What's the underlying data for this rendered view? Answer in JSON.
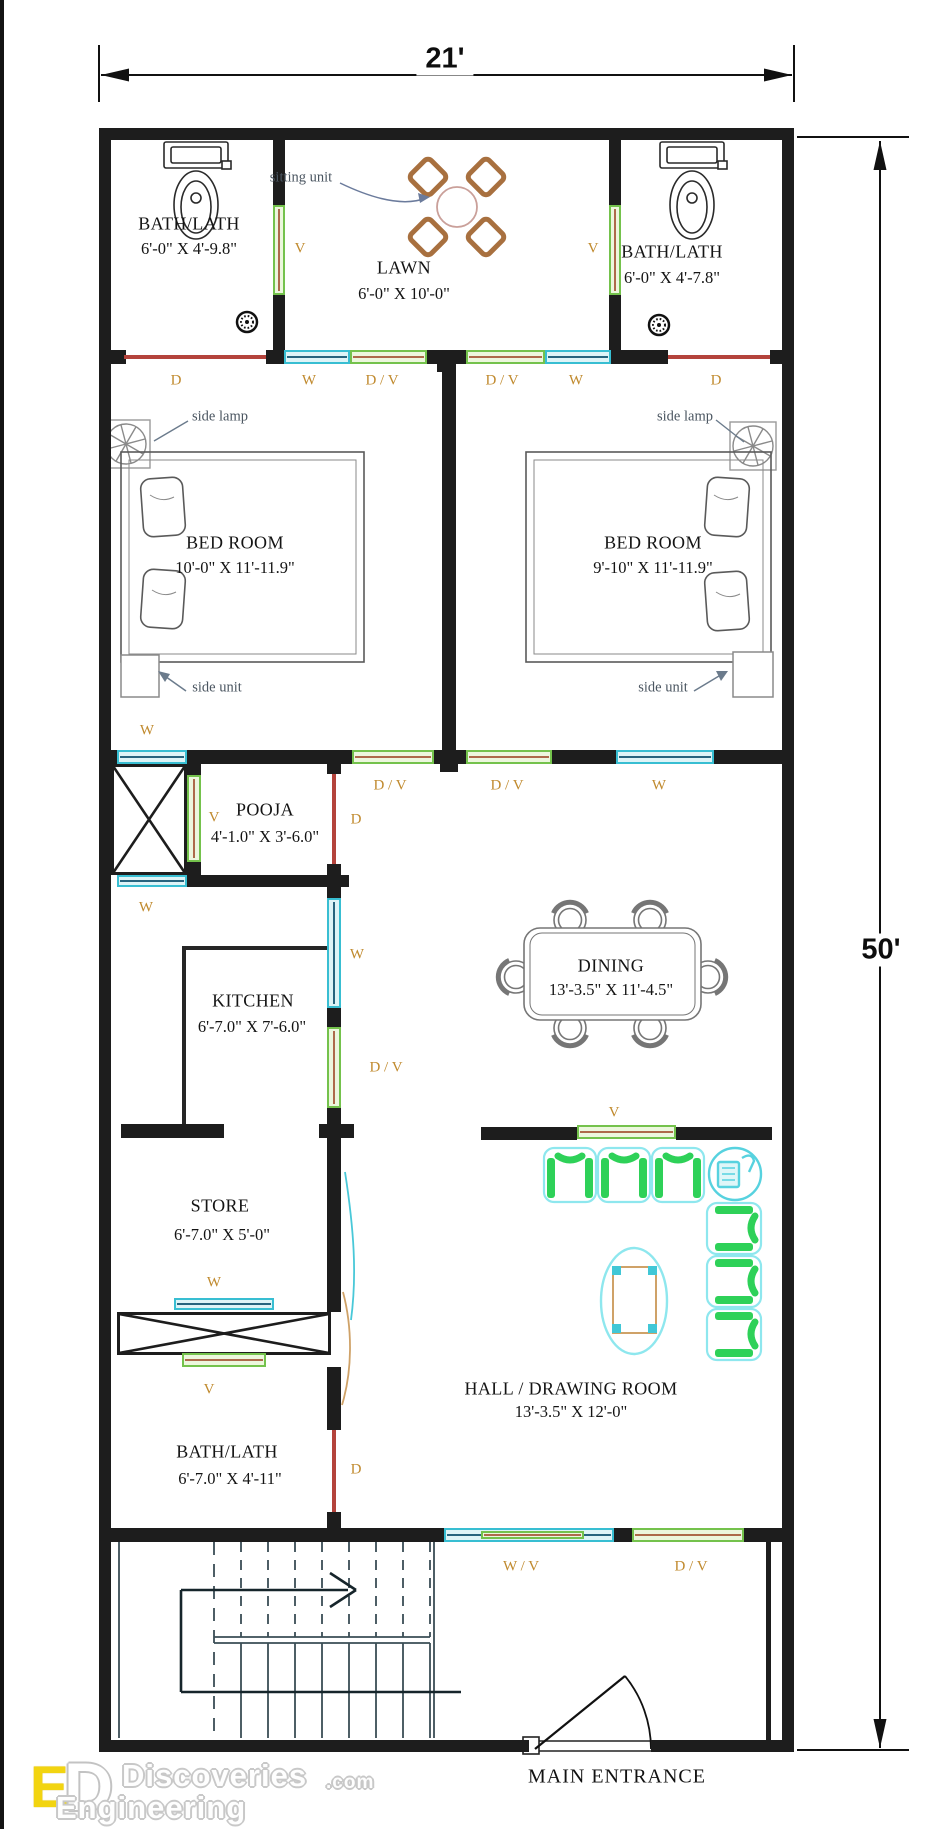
{
  "plan": {
    "dim_width": "21'",
    "dim_height": "50'"
  },
  "rooms": {
    "bath_top_left": {
      "name": "BATH/LATH",
      "dims": "6'-0\" X 4'-9.8\""
    },
    "lawn": {
      "name": "LAWN",
      "dims": "6'-0\" X 10'-0\""
    },
    "bath_top_right": {
      "name": "BATH/LATH",
      "dims": "6'-0\" X 4'-7.8\""
    },
    "bed_left": {
      "name": "BED ROOM",
      "dims": "10'-0\" X 11'-11.9\""
    },
    "bed_right": {
      "name": "BED ROOM",
      "dims": "9'-10\" X 11'-11.9\""
    },
    "pooja": {
      "name": "POOJA",
      "dims": "4'-1.0\" X 3'-6.0\""
    },
    "kitchen": {
      "name": "KITCHEN",
      "dims": "6'-7.0\" X 7'-6.0\""
    },
    "dining": {
      "name": "DINING",
      "dims": "13'-3.5\" X 11'-4.5\""
    },
    "store": {
      "name": "STORE",
      "dims": "6'-7.0\" X 5'-0\""
    },
    "bath_bottom": {
      "name": "BATH/LATH",
      "dims": "6'-7.0\" X 4'-11\""
    },
    "hall": {
      "name": "HALL / DRAWING ROOM",
      "dims": "13'-3.5\" X 12'-0\""
    }
  },
  "openings": {
    "door": "D",
    "window": "W",
    "vent": "V",
    "door_vent": "D / V",
    "window_vent": "W / V"
  },
  "annotations": {
    "sitting_unit": "sitting unit",
    "side_lamp": "side lamp",
    "side_unit": "side unit"
  },
  "entrance": {
    "label": "MAIN ENTRANCE"
  },
  "watermark": {
    "monogram_e": "E",
    "monogram_d": "D",
    "line1": "Discoveries",
    "tld": ".com",
    "line2": "Engineering"
  },
  "colors": {
    "wall": "#1d1d1d",
    "door_red": "#b4433c",
    "window_cyan": "#38bed2",
    "vent_green": "#74c24c",
    "sofa_green": "#2ed158",
    "sofa_outline": "#8ee7ee",
    "label_orange": "#c08a2e",
    "furniture_gray": "#777777",
    "wood_brown": "#a8703f",
    "logo_yellow": "#f2d410"
  }
}
